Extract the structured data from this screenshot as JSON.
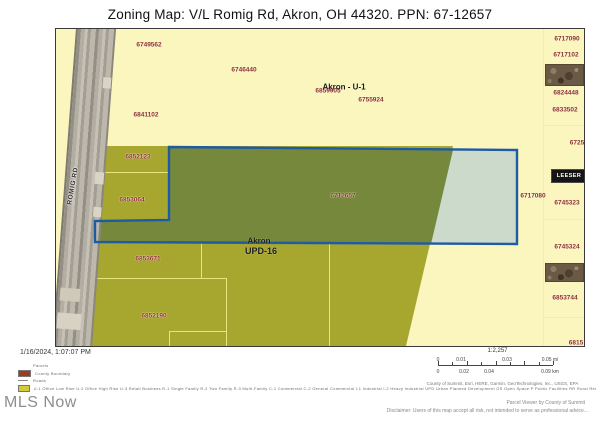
{
  "title": "Zoning Map: V/L Romig Rd, Akron, OH 44320. PPN: 67-12657",
  "colors": {
    "map_bg": "#FAF6BE",
    "zone_olive": "#A7A72F",
    "zone_olive_selected": "#75883B",
    "selection_light": "#CCDACB",
    "selection_border": "#1E5AA5",
    "parcel_number_text": "#8E2F2F"
  },
  "map": {
    "road_label": "ROMIG RD",
    "leeser_label": "LEESER",
    "labels_red": [
      {
        "t": "6749562",
        "x": 93,
        "y": 16
      },
      {
        "t": "6746440",
        "x": 188,
        "y": 41
      },
      {
        "t": "6859905",
        "x": 272,
        "y": 62
      },
      {
        "t": "6755924",
        "x": 315,
        "y": 71
      },
      {
        "t": "6841102",
        "x": 90,
        "y": 86
      },
      {
        "t": "6852123",
        "x": 82,
        "y": 128
      },
      {
        "t": "6853064",
        "x": 76,
        "y": 171
      },
      {
        "t": "6712657",
        "x": 287,
        "y": 167
      },
      {
        "t": "6717080",
        "x": 477,
        "y": 167
      },
      {
        "t": "6853671",
        "x": 92,
        "y": 230
      },
      {
        "t": "6852190",
        "x": 98,
        "y": 287
      },
      {
        "t": "6717090",
        "x": 511,
        "y": 10
      },
      {
        "t": "6717102",
        "x": 510,
        "y": 26
      },
      {
        "t": "6824448",
        "x": 510,
        "y": 64
      },
      {
        "t": "6833502",
        "x": 509,
        "y": 81
      },
      {
        "t": "6725",
        "x": 521,
        "y": 114
      },
      {
        "t": "6745323",
        "x": 511,
        "y": 174
      },
      {
        "t": "6745324",
        "x": 511,
        "y": 218
      },
      {
        "t": "6853744",
        "x": 509,
        "y": 269
      },
      {
        "t": "6815",
        "x": 520,
        "y": 314
      }
    ],
    "labels_black": [
      {
        "t": "Akron - U-1",
        "x": 288,
        "y": 58,
        "fs": 8
      },
      {
        "t": "Akron",
        "x": 203,
        "y": 212,
        "fs": 8
      },
      {
        "t": "UPD-16",
        "x": 205,
        "y": 222,
        "fs": 9
      }
    ]
  },
  "footer": {
    "timestamp": "1/16/2024, 1:07:07 PM",
    "brand": "MLS Now",
    "credit": "Parcel Viewer by County of Summit",
    "disclaimer": "Disclaimer: Users of this map accept all risk, not intended to serve as professional advice..."
  },
  "legend": {
    "rows": [
      {
        "type": "text",
        "color": "",
        "label": "Parcels"
      },
      {
        "type": "swatch",
        "color": "#9e3a28",
        "label": "County Boundary"
      },
      {
        "type": "line",
        "color": "#8a8a8a",
        "label": "Roads"
      },
      {
        "type": "swatch",
        "color": "#d6c93c",
        "label": "U-1 Office Low Rise   U-2 Office High Rise   U-3 Retail Business   R-1 Single Family   R-2 Two Family   R-3 Multi-Family   C-1 Commercial   C-2 General Commercial   I-1 Industrial   I-2 Heavy Industrial   UPD Urban Planned Development   OS Open Space   P Public Facilities   RR Rural Residential   CBD Central Business District"
      }
    ]
  },
  "scale": {
    "ratio": "1:2,257",
    "mi_labels": [
      {
        "t": "0",
        "x": 0
      },
      {
        "t": "0.01",
        "x": 23
      },
      {
        "t": "0.03",
        "x": 69
      },
      {
        "t": "0.05 mi",
        "x": 112
      }
    ],
    "km_labels": [
      {
        "t": "0",
        "x": 0
      },
      {
        "t": "0.02",
        "x": 26
      },
      {
        "t": "0.04",
        "x": 51
      },
      {
        "t": "0.09 km",
        "x": 112
      }
    ],
    "attribution": "County of Summit, Esri, HERE, Garmin, GeoTechnologies, Inc., USGS, EPA"
  }
}
